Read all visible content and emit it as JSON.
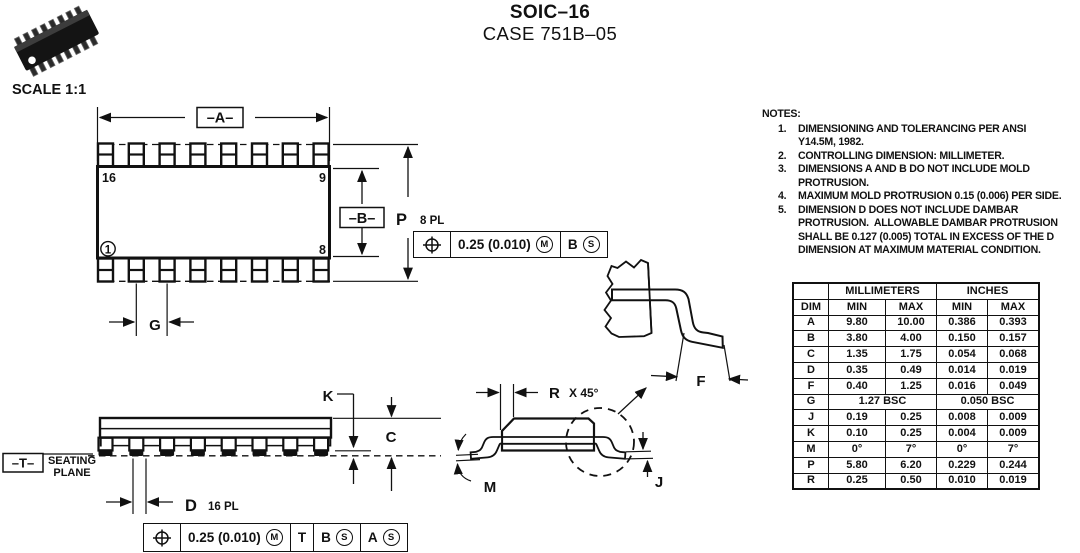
{
  "title": {
    "product": "SOIC–16",
    "case": "CASE 751B–05"
  },
  "scale_label": "SCALE 1:1",
  "top_view": {
    "dim_a_label": "–A–",
    "dim_b_label": "–B–",
    "dim_g_label": "G",
    "dim_p_label": "P",
    "dim_p_places": "8 PL",
    "pin16": "16",
    "pin9": "9",
    "pin8": "8",
    "pin1": "1",
    "fcf": {
      "tolerance": "0.25 (0.010)",
      "tolerance_modifier": "M",
      "datum_b": "B",
      "datum_b_modifier": "S"
    }
  },
  "side_view": {
    "datum_t_label": "–T–",
    "seating_plane_label": "SEATING\nPLANE",
    "dim_k_label": "K",
    "dim_c_label": "C",
    "dim_d_label": "D",
    "dim_d_places": "16 PL",
    "fcf": {
      "tolerance": "0.25 (0.010)",
      "tolerance_modifier": "M",
      "datum_t": "T",
      "datum_b": "B",
      "datum_b_modifier": "S",
      "datum_a": "A",
      "datum_a_modifier": "S"
    }
  },
  "end_view": {
    "dim_r_label": "R",
    "dim_r_suffix": "X 45°",
    "dim_m_label": "M",
    "dim_j_label": "J",
    "detail": {
      "dim_f_label": "F"
    }
  },
  "notes": {
    "heading": "NOTES:",
    "items": [
      {
        "num": "1.",
        "text": "DIMENSIONING AND TOLERANCING PER ANSI\nY14.5M, 1982."
      },
      {
        "num": "2.",
        "text": "CONTROLLING DIMENSION: MILLIMETER."
      },
      {
        "num": "3.",
        "text": "DIMENSIONS A AND B DO NOT INCLUDE MOLD\nPROTRUSION."
      },
      {
        "num": "4.",
        "text": "MAXIMUM MOLD PROTRUSION 0.15 (0.006) PER SIDE."
      },
      {
        "num": "5.",
        "text": "DIMENSION D DOES NOT INCLUDE DAMBAR\nPROTRUSION.  ALLOWABLE DAMBAR PROTRUSION\nSHALL BE 0.127 (0.005) TOTAL IN EXCESS OF THE D\nDIMENSION AT MAXIMUM MATERIAL CONDITION."
      }
    ]
  },
  "dim_table": {
    "headers": {
      "dim": "DIM",
      "millimeters": "MILLIMETERS",
      "inches": "INCHES",
      "mm_min": "MIN",
      "mm_max": "MAX",
      "in_min": "MIN",
      "in_max": "MAX"
    },
    "rows": [
      {
        "dim": "A",
        "mm_min": "9.80",
        "mm_max": "10.00",
        "in_min": "0.386",
        "in_max": "0.393"
      },
      {
        "dim": "B",
        "mm_min": "3.80",
        "mm_max": "4.00",
        "in_min": "0.150",
        "in_max": "0.157"
      },
      {
        "dim": "C",
        "mm_min": "1.35",
        "mm_max": "1.75",
        "in_min": "0.054",
        "in_max": "0.068"
      },
      {
        "dim": "D",
        "mm_min": "0.35",
        "mm_max": "0.49",
        "in_min": "0.014",
        "in_max": "0.019"
      },
      {
        "dim": "F",
        "mm_min": "0.40",
        "mm_max": "1.25",
        "in_min": "0.016",
        "in_max": "0.049"
      },
      {
        "dim": "G",
        "mm_span": "1.27 BSC",
        "in_span": "0.050 BSC"
      },
      {
        "dim": "J",
        "mm_min": "0.19",
        "mm_max": "0.25",
        "in_min": "0.008",
        "in_max": "0.009"
      },
      {
        "dim": "K",
        "mm_min": "0.10",
        "mm_max": "0.25",
        "in_min": "0.004",
        "in_max": "0.009"
      },
      {
        "dim": "M",
        "mm_min": "0°",
        "mm_max": "7°",
        "in_min": "0°",
        "in_max": "7°"
      },
      {
        "dim": "P",
        "mm_min": "5.80",
        "mm_max": "6.20",
        "in_min": "0.229",
        "in_max": "0.244"
      },
      {
        "dim": "R",
        "mm_min": "0.25",
        "mm_max": "0.50",
        "in_min": "0.010",
        "in_max": "0.019"
      }
    ]
  }
}
